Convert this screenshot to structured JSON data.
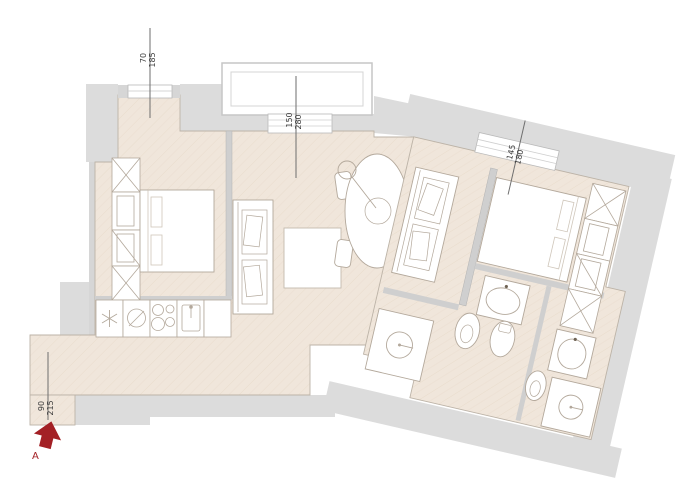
{
  "plan": {
    "type": "apartment-floor-plan",
    "dimensions": [
      {
        "name": "left-window",
        "value": "70",
        "total": "185"
      },
      {
        "name": "terrace-door",
        "value": "150",
        "total": "280"
      },
      {
        "name": "right-window",
        "value": "145",
        "total": "180"
      },
      {
        "name": "entrance",
        "value": "90",
        "total": "215"
      }
    ],
    "entrance": {
      "label": "A"
    },
    "colors": {
      "floor": "#f0e6db",
      "exterior_band": "#dcdcdc",
      "wall": "#cfcfcf",
      "furniture_line": "#b3a89b",
      "dimension_line": "#6e6e6e",
      "accent_red": "#a32025"
    },
    "icons": [
      "wardrobe-icon",
      "bed-icon",
      "sofa-icon",
      "coffee-table-icon",
      "dining-table-icon",
      "chair-icon",
      "pendant-lamp-icon",
      "fridge-icon",
      "oven-icon",
      "cooktop-icon",
      "sink-icon",
      "washbasin-icon",
      "bidet-icon",
      "toilet-icon",
      "shower-icon",
      "entrance-arrow-icon",
      "balcony",
      "window-opening"
    ]
  }
}
